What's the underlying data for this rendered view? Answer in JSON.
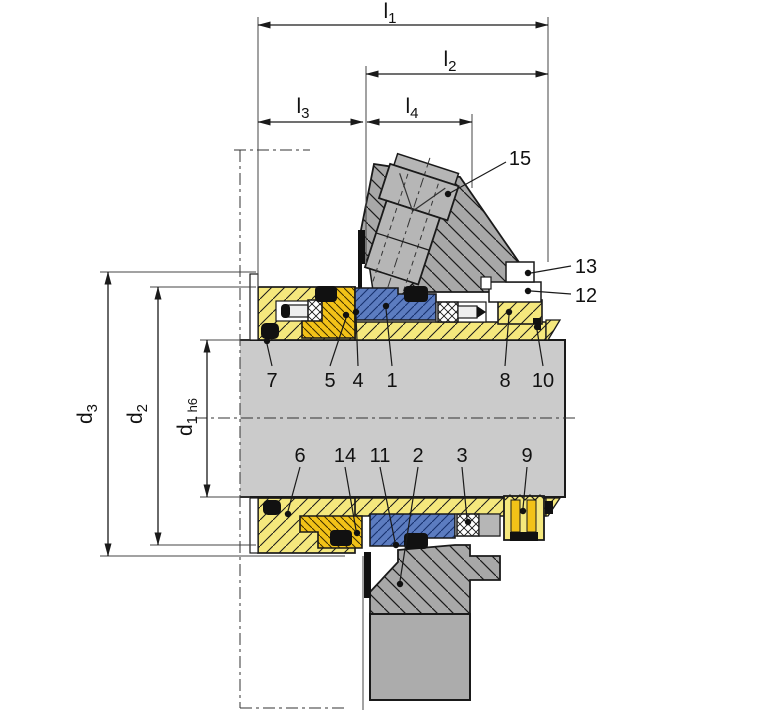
{
  "figure": {
    "dim_labels": {
      "l1": {
        "base": "l",
        "sub": "1"
      },
      "l2": {
        "base": "l",
        "sub": "2"
      },
      "l3": {
        "base": "l",
        "sub": "3"
      },
      "l4": {
        "base": "l",
        "sub": "4"
      },
      "d3": {
        "base": "d",
        "sub": "3"
      },
      "d2": {
        "base": "d",
        "sub": "2"
      },
      "d1": {
        "base": "d",
        "sub": "1",
        "tolerance": " h6"
      }
    },
    "callouts": {
      "c1": "1",
      "c2": "2",
      "c3": "3",
      "c4": "4",
      "c5": "5",
      "c6": "6",
      "c7": "7",
      "c8": "8",
      "c9": "9",
      "c10": "10",
      "c11": "11",
      "c12": "12",
      "c13": "13",
      "c14": "14",
      "c15": "15"
    },
    "colors": {
      "housing_yellow": "#F5E87D",
      "drive_gold": "#F2C218",
      "seal_blue": "#5C7CC0",
      "seal_blue_hatch": "#17316E",
      "shaft_gray": "#CBCBCB",
      "gland_gray": "#A8A8A8",
      "plug_gray": "#B6B6B6",
      "block_gray": "#ACACAC",
      "outline": "#1A1A1A"
    }
  }
}
